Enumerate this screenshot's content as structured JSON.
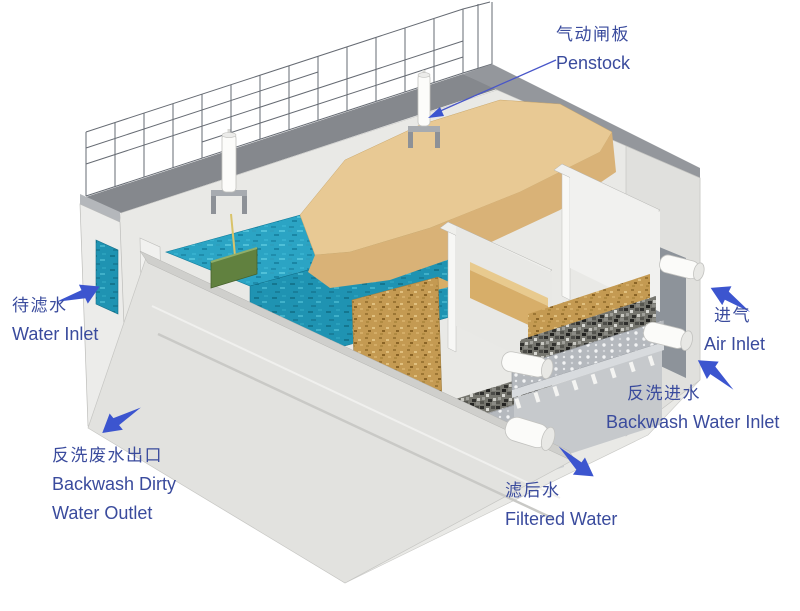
{
  "diagram": {
    "type": "3d-cutaway-filter-tank-schematic",
    "labels": {
      "penstock": {
        "zh": "气动闸板",
        "en": "Penstock"
      },
      "water_inlet": {
        "zh": "待滤水",
        "en": "Water Inlet"
      },
      "backwash_dirty_water_outlet": {
        "zh": "反洗废水出口",
        "en_line1": "Backwash Dirty",
        "en_line2": "Water Outlet"
      },
      "air_inlet": {
        "zh": "进气",
        "en": "Air Inlet"
      },
      "backwash_water_inlet": {
        "zh": "反洗进水",
        "en": "Backwash Water Inlet"
      },
      "filtered_water": {
        "zh": "滤后水",
        "en": "Filtered Water"
      }
    },
    "palette": {
      "label_text": "#3a4b9d",
      "arrow_blue": "#3c55cf",
      "water": "#2ba4c4",
      "water_dark": "#1f93b2",
      "sand_smooth": "#d9b277",
      "sand_light": "#e8c994",
      "sand_cut": "#c49a52",
      "gravel": "#76766f",
      "plate_gray": "#b5b9be",
      "concrete_light": "#ededea",
      "concrete_face": "#e2e2df",
      "deck_gray": "#85888d",
      "gate_green": "#61813f",
      "trough_tan": "#c79b3f"
    }
  }
}
